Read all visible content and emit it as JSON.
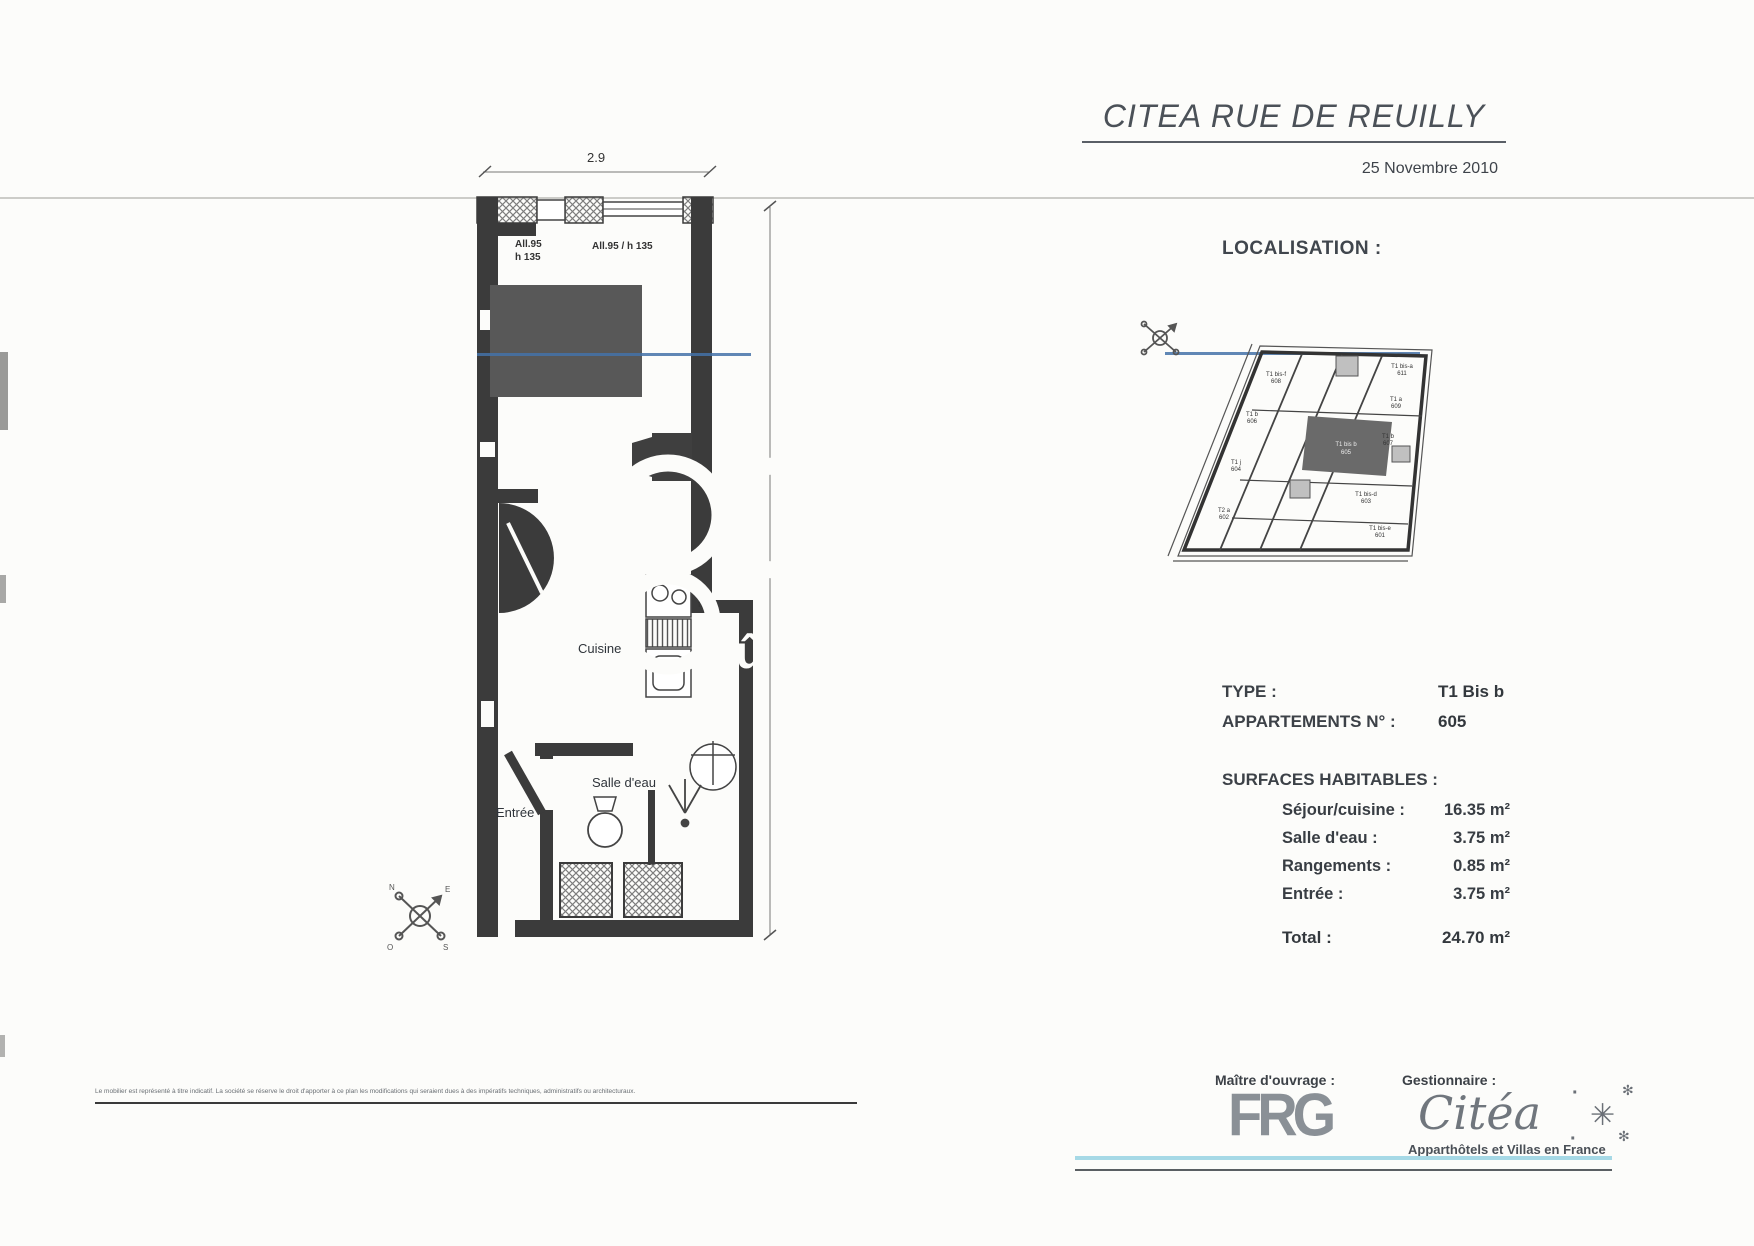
{
  "header": {
    "title": "CITEA RUE DE REUILLY",
    "date": "25 Novembre 2010"
  },
  "localisation_label": "LOCALISATION :",
  "plan": {
    "dim_width": "2.9",
    "dim_height": "9.7",
    "window_left_line1": "All.95",
    "window_left_line2": "h 135",
    "window_right": "All.95 / h 135",
    "room_cuisine": "Cuisine",
    "room_salle_eau": "Salle d'eau",
    "room_entree": "Entrée",
    "note": "f.jt."
  },
  "watermark": {
    "text": "sû"
  },
  "minimap": {
    "units": [
      {
        "type": "T1 bis-f",
        "num": "608"
      },
      {
        "type": "T1 bis-a",
        "num": "611"
      },
      {
        "type": "T1 a",
        "num": "609"
      },
      {
        "type": "T1 b",
        "num": "606"
      },
      {
        "type": "T1 b",
        "num": "607"
      },
      {
        "type": "T1 j",
        "num": "604"
      },
      {
        "type": "T1 bis b",
        "num": "605"
      },
      {
        "type": "T1 bis-d",
        "num": "603"
      },
      {
        "type": "T2 a",
        "num": "602"
      },
      {
        "type": "T1 bis-e",
        "num": "601"
      }
    ]
  },
  "details": {
    "type_label": "TYPE :",
    "type_value": "T1 Bis b",
    "apt_label": "APPARTEMENTS N° :",
    "apt_value": "605"
  },
  "surfaces": {
    "heading": "SURFACES HABITABLES :",
    "rows": [
      {
        "label": "Séjour/cuisine :",
        "value": "16.35 m²"
      },
      {
        "label": "Salle d'eau :",
        "value": "3.75 m²"
      },
      {
        "label": "Rangements :",
        "value": "0.85 m²"
      },
      {
        "label": "Entrée :",
        "value": "3.75 m²"
      }
    ],
    "total_label": "Total :",
    "total_value": "24.70 m²"
  },
  "footer": {
    "moa_label": "Maître d'ouvrage :",
    "moa_logo": "FRG",
    "gest_label": "Gestionnaire :",
    "gest_logo": "Citéa",
    "gest_tagline": "Apparthôtels et Villas en France",
    "disclaimer": "Le mobilier est représenté à titre indicatif. La société se réserve le droit d'apporter à ce plan les modifications qui seraient dues à des impératifs techniques, administratifs ou architecturaux."
  },
  "colors": {
    "scan_blue": "#4472a8",
    "scan_cyan": "#a6d9e6",
    "ink": "#3b3b3b"
  }
}
